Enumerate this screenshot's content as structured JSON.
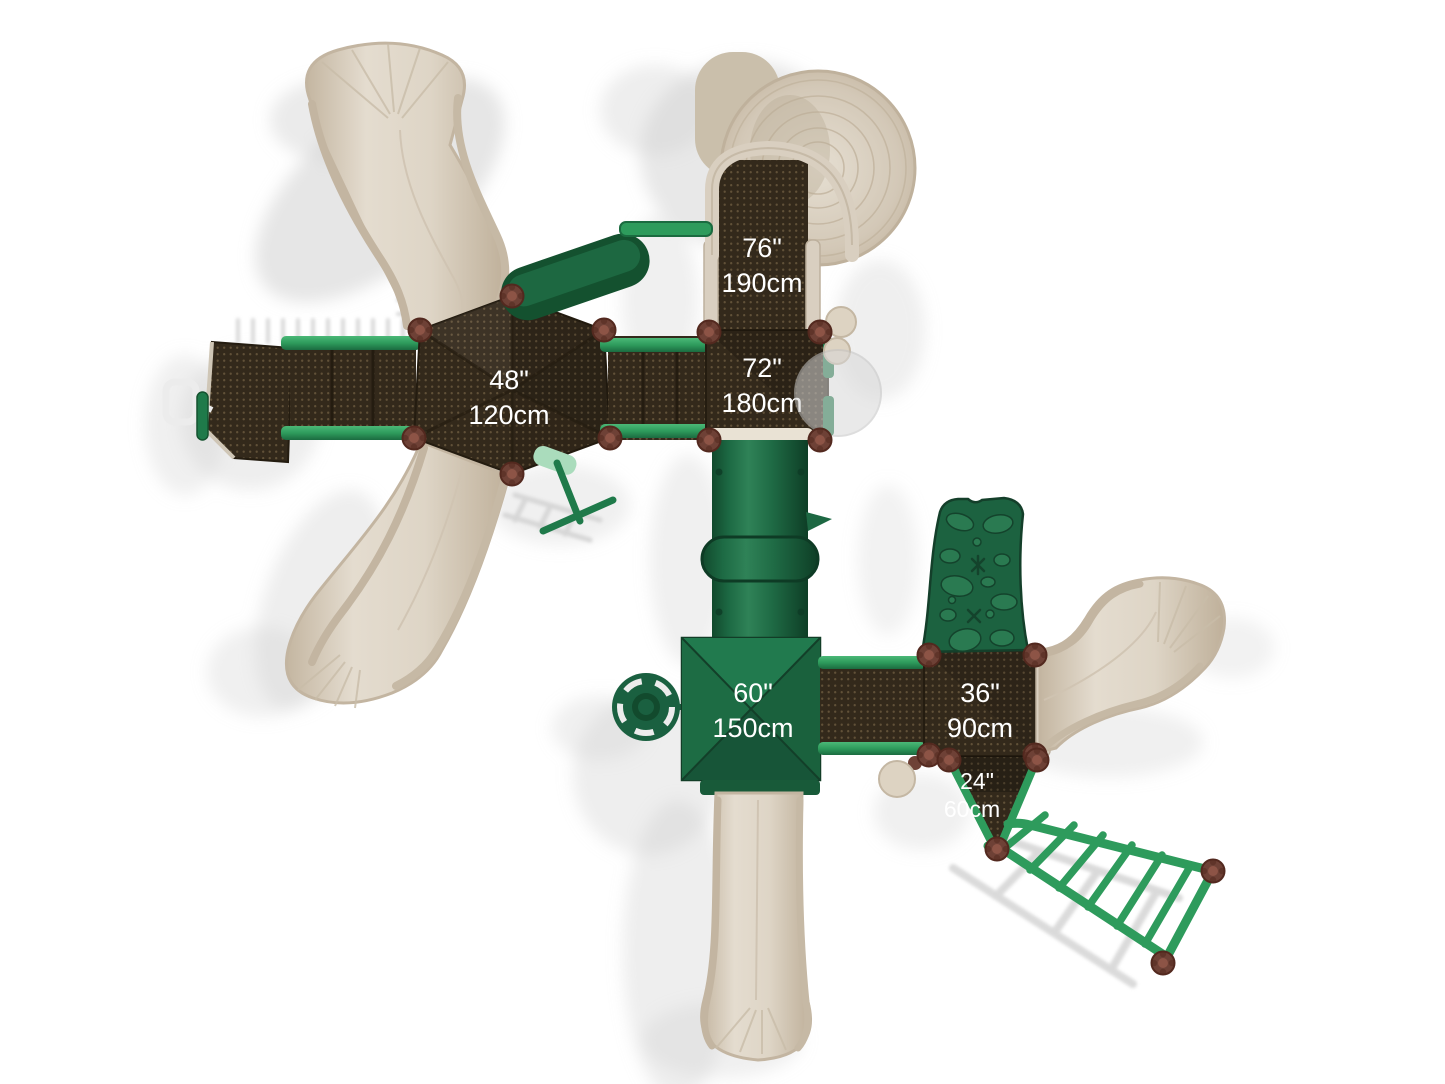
{
  "labels": {
    "walkway": {
      "in": "76\"",
      "cm": "190cm"
    },
    "deck72": {
      "in": "72\"",
      "cm": "180cm"
    },
    "deck48": {
      "in": "48\"",
      "cm": "120cm"
    },
    "deck60": {
      "in": "60\"",
      "cm": "150cm"
    },
    "deck36": {
      "in": "36\"",
      "cm": "90cm"
    },
    "deck24": {
      "in": "24\"",
      "cm": "60cm"
    }
  },
  "colors": {
    "background": "#ffffff",
    "deck_brown": "#33291b",
    "deck_perforation": "#907a55",
    "slide_beige": "#d8cec0",
    "slide_edge": "#c3b5a1",
    "green_dark": "#1d6843",
    "green_bright": "#2e9b5c",
    "post_cap_brown": "#6e4136",
    "shadow_gray": "#cdcdcd",
    "label_text": "#ffffff"
  }
}
